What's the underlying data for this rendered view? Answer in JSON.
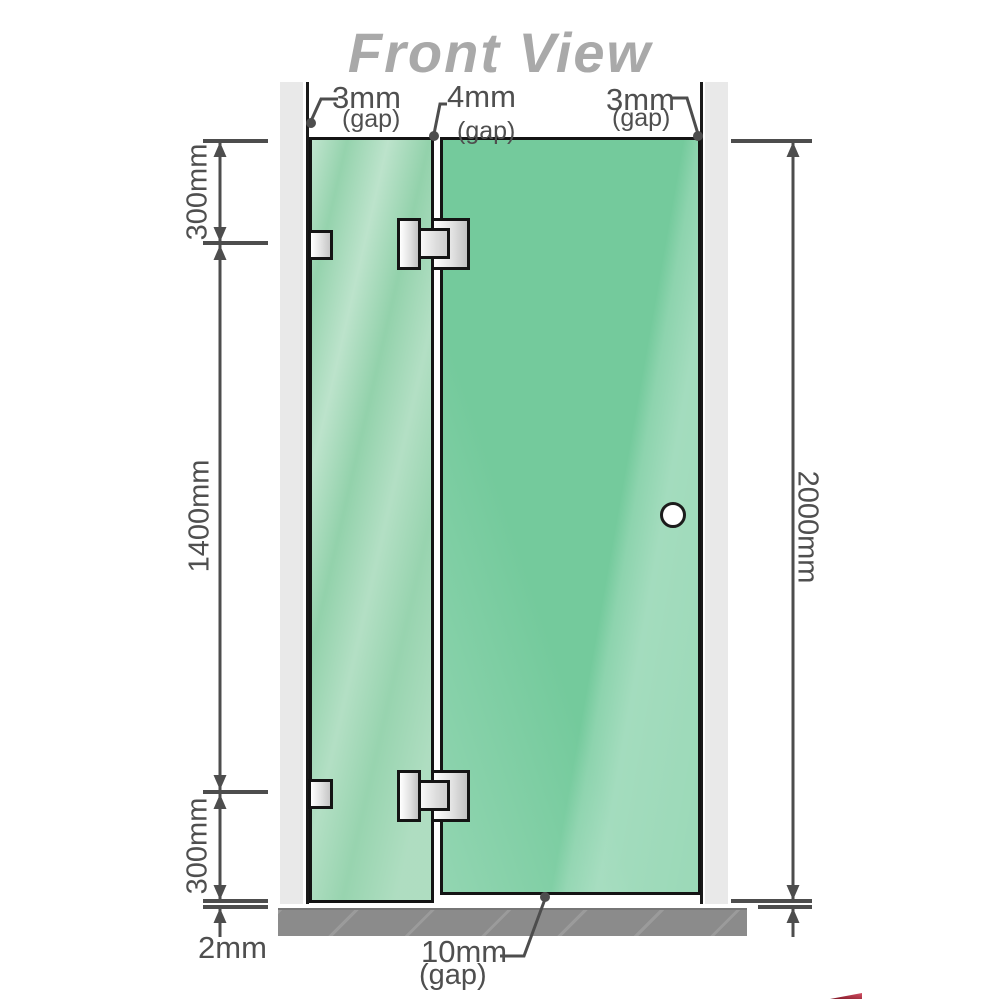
{
  "title": "Front View",
  "annotations": {
    "top_left_gap": {
      "value": "3mm",
      "note": "(gap)"
    },
    "top_center_gap": {
      "value": "4mm",
      "note": "(gap)"
    },
    "top_right_gap": {
      "value": "3mm",
      "note": "(gap)"
    },
    "left_top_segment": "300mm",
    "left_middle_segment": "1400mm",
    "left_bottom_segment": "300mm",
    "right_total_height": "2000mm",
    "bottom_floor_gap": "2mm",
    "bottom_door_gap": {
      "value": "10mm",
      "note": "(gap)"
    }
  },
  "colors": {
    "title_gray": "#a9a9a9",
    "glass_fixed_panel": "#8ccfa6",
    "glass_door_panel": "#74ca9c",
    "wall": "#e9e9e9",
    "floor": "#8b8b8b",
    "dimension_lines": "#4d4d4d",
    "hardware_border": "#141414",
    "logo_fragment_red": "#7d1422"
  }
}
